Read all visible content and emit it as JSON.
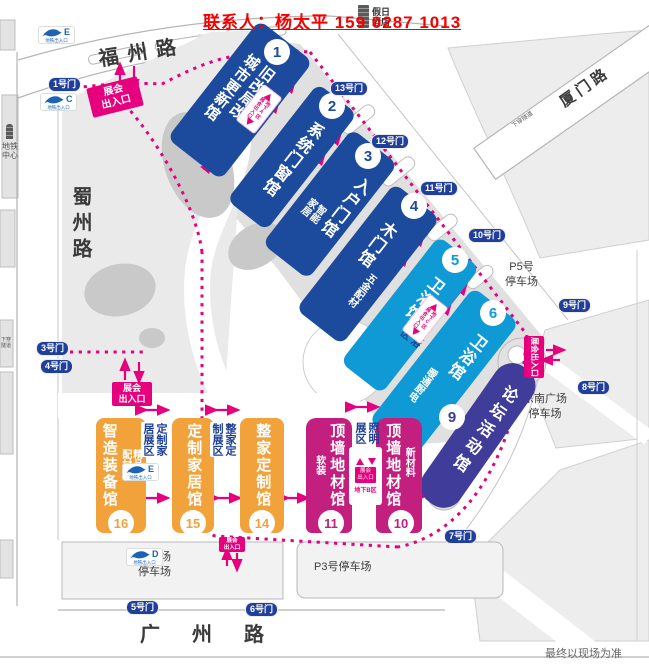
{
  "header": {
    "contact": "联系人：杨太平 159 0287 1013",
    "hotel": [
      "假日",
      "酒店"
    ]
  },
  "roads": {
    "fuzhou": "福州路",
    "shuzhou": "蜀州路",
    "guangzhou": "广州路",
    "xiamen": "厦门路",
    "tunnel": "下穿隧道"
  },
  "metro": {
    "center": [
      "地铁",
      "中心"
    ],
    "caption": "地铁出入口",
    "entrances": [
      "E",
      "C",
      "E",
      "D"
    ]
  },
  "gates": {
    "g1": "1号门",
    "g3": "3号门",
    "g4": "4号门",
    "g5": "5号门",
    "g6": "6号门",
    "g7": "7号门",
    "g8": "8号门",
    "g9": "9号门",
    "g10": "10号门",
    "g11": "11号门",
    "g12": "12号门",
    "g13": "13号门"
  },
  "halls": {
    "h1": {
      "num": "1",
      "cols": [
        "旧改局改",
        "城市更新馆"
      ]
    },
    "h2": {
      "num": "2",
      "cols": [
        "系统门窗馆"
      ]
    },
    "h3": {
      "num": "3",
      "cols": [
        "入户门馆"
      ],
      "sub": "智能家居"
    },
    "h4": {
      "num": "4",
      "cols": [
        "木门馆"
      ],
      "sub": "五金配材"
    },
    "h5": {
      "num": "5",
      "cols": [
        "卫浴馆"
      ]
    },
    "h6": {
      "num": "6",
      "cols": [
        "卫浴馆"
      ],
      "sub": "暖通厨电"
    },
    "h9": {
      "num": "9",
      "cols": [
        "论坛活动馆"
      ]
    },
    "h10": {
      "num": "10",
      "cols": [
        "顶墙地材馆"
      ],
      "sub": "新材料"
    },
    "h11": {
      "num": "11",
      "cols": [
        "顶墙地材馆"
      ],
      "sub": "软装"
    },
    "h14": {
      "num": "14",
      "cols": [
        "整家定制馆"
      ]
    },
    "h15": {
      "num": "15",
      "cols": [
        "定制家居馆"
      ]
    },
    "h16": {
      "num": "16",
      "cols": [
        "智造装备馆"
      ],
      "sub": "精品配材"
    }
  },
  "zones": {
    "custom_home": [
      "定制家",
      "居展区"
    ],
    "whole_home": [
      "整家定",
      "制展区"
    ],
    "lighting": [
      "照明",
      "展区"
    ],
    "bath": [
      "卫浴",
      "展区"
    ]
  },
  "entrance": {
    "label": "展会出入口",
    "lines": [
      "展会",
      "出入口"
    ]
  },
  "underground": {
    "a": "地下A区",
    "b": "地下B区",
    "c": "地下C区"
  },
  "parking": {
    "p5": [
      "P5号",
      "停车场"
    ],
    "southeast": [
      "东南广场",
      "停车场"
    ],
    "p3": "P3号停车场",
    "south": [
      "南广场",
      "停车场"
    ]
  },
  "footnote": "最终以现场为准",
  "colors": {
    "accent": "#e6007e",
    "hall_blue": "#1c4b9e",
    "hall_lightblue": "#0f9ad6",
    "hall_indigo": "#403c99",
    "hall_magenta": "#c21f7e",
    "hall_orange": "#f2a23a",
    "gate": "#203f9a",
    "contact_red": "#f40000"
  }
}
